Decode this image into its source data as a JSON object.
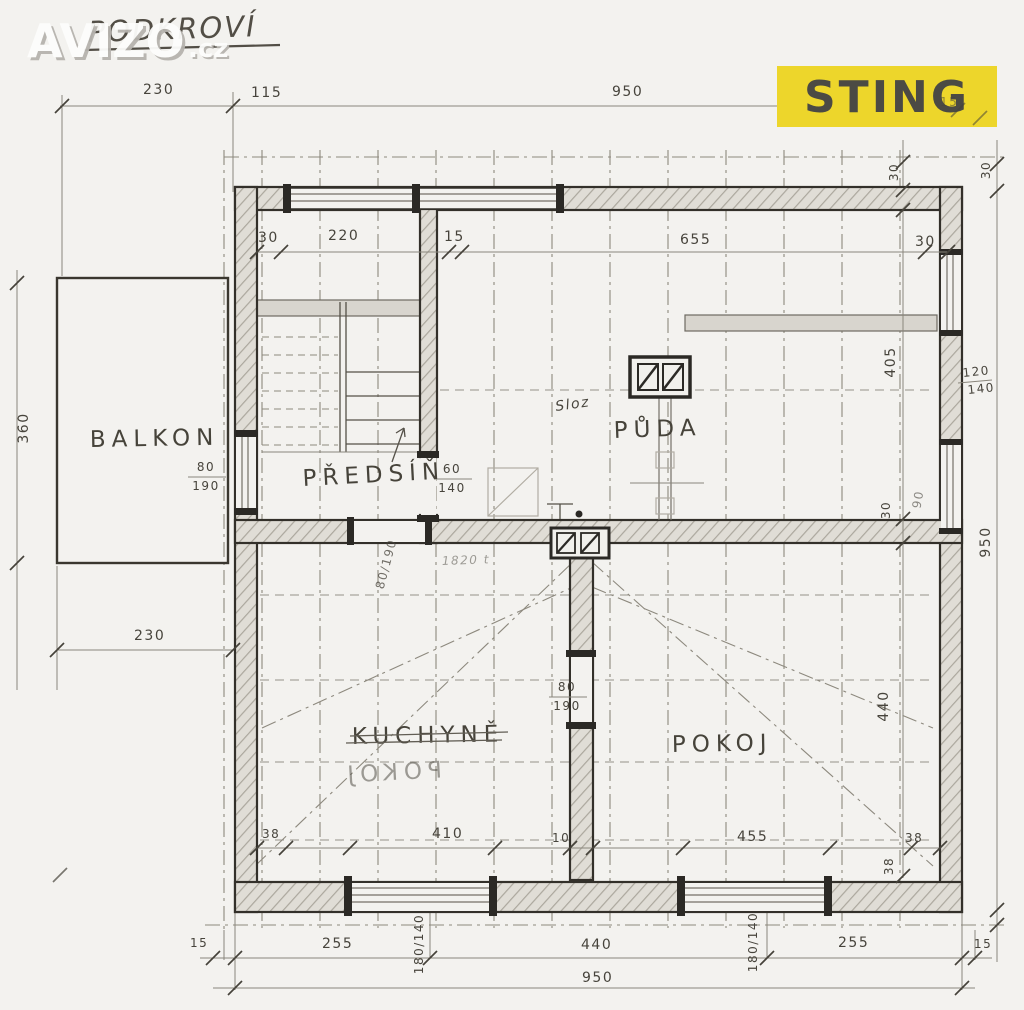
{
  "page": {
    "title": "PODKROVÍ"
  },
  "watermark": {
    "brand": "AVIZO",
    "tld": ".cz"
  },
  "badge": {
    "label": "STING",
    "bg": "#edd62b",
    "fg": "#4b4a44"
  },
  "colors": {
    "paper": "#f3f2ef",
    "pencil": "#47443c",
    "wall_outline": "#33302a"
  },
  "rooms": {
    "balkon": "BALKON",
    "predsin": "PŘEDSÍŇ",
    "puda": "PŮDA",
    "kuchyne": "KUCHYNĚ",
    "pokoj": "POKOJ",
    "pokoj_bleed": "POKOJ"
  },
  "dims": {
    "t230": "230",
    "t115": "115",
    "t950": "950",
    "u30l": "30",
    "u220": "220",
    "u15": "15",
    "u655": "655",
    "u30r": "30",
    "v30a": "30",
    "v30b": "30",
    "l360": "360",
    "l230": "230",
    "r405": "405",
    "r30": "30",
    "r440": "440",
    "r950": "950",
    "r90": "90",
    "w120": "120",
    "w140": "140",
    "b38l": "38",
    "b410": "410",
    "b10": "10",
    "b455": "455",
    "b38r": "38",
    "b38v": "38",
    "f15l": "15",
    "f255l": "255",
    "fw1": "180/140",
    "f440": "440",
    "fw2": "180/140",
    "f255r": "255",
    "f15r": "15",
    "f950": "950",
    "corner15": "15"
  },
  "doors": {
    "balc_w": "80",
    "balc_h": "190",
    "mid": "80/190",
    "kit_w": "80",
    "kit_h": "190",
    "st_w": "60",
    "st_h": "140"
  },
  "notes": {
    "sloz": "Sloz",
    "scribble": "1820 t"
  }
}
